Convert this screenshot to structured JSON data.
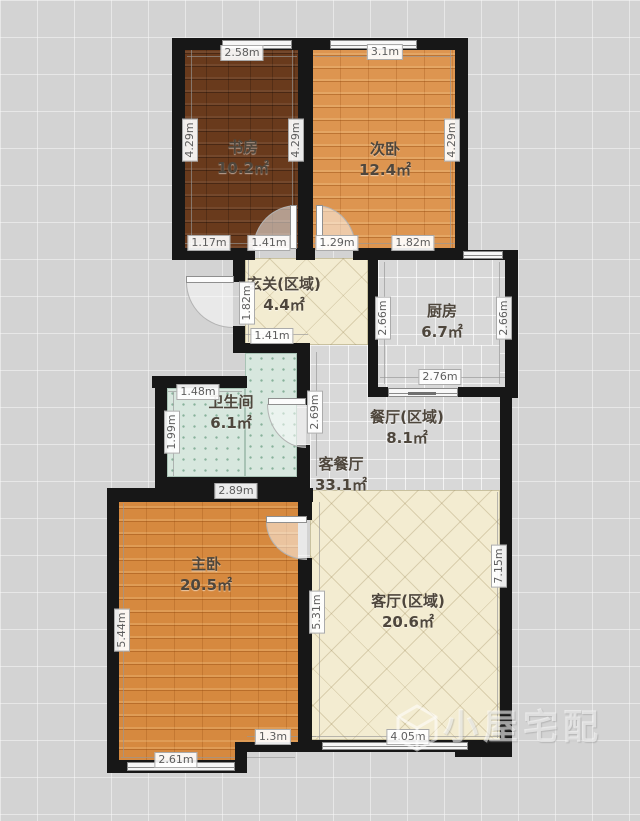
{
  "rooms": {
    "study": {
      "name": "书房",
      "area": "10.2㎡"
    },
    "second_bedroom": {
      "name": "次卧",
      "area": "12.4㎡"
    },
    "entry": {
      "name": "玄关(区域)",
      "area": "4.4㎡"
    },
    "kitchen": {
      "name": "厨房",
      "area": "6.7㎡"
    },
    "bathroom": {
      "name": "卫生间",
      "area": "6.1㎡"
    },
    "dining": {
      "name": "餐厅(区域)",
      "area": "8.1㎡"
    },
    "living_dining": {
      "name": "客餐厅",
      "area": "33.1㎡"
    },
    "master_bedroom": {
      "name": "主卧",
      "area": "20.5㎡"
    },
    "living": {
      "name": "客厅(区域)",
      "area": "20.6㎡"
    }
  },
  "dims": {
    "study_top": "2.58m",
    "second_top": "3.1m",
    "study_left": "4.29m",
    "study_right": "4.29m",
    "second_right": "4.29m",
    "study_bottom_left": "1.17m",
    "study_bottom_right": "1.41m",
    "second_bottom_left": "1.29m",
    "second_bottom_right": "1.82m",
    "entry_left": "1.82m",
    "entry_bottom": "1.41m",
    "kitchen_left": "2.66m",
    "kitchen_right": "2.66m",
    "kitchen_bottom": "2.76m",
    "bath_top": "1.48m",
    "bath_left": "1.99m",
    "hall_height": "2.69m",
    "bath_bottom": "2.89m",
    "master_left": "5.44m",
    "master_right": "5.31m",
    "living_right": "7.15m",
    "master_bottom": "2.61m",
    "master_bottom_right": "1.3m",
    "living_bottom": "4.05m"
  },
  "watermark": {
    "text": "小屋宅配",
    "logo": "cube-logo"
  },
  "colors": {
    "wall": "#171717",
    "wood_dark": "#693a1c",
    "wood_orange": "#d6893f",
    "cream": "#f3ecd1",
    "tile": "#d8d8d8",
    "bath": "#d7e7de",
    "background": "#d3d3d3"
  }
}
